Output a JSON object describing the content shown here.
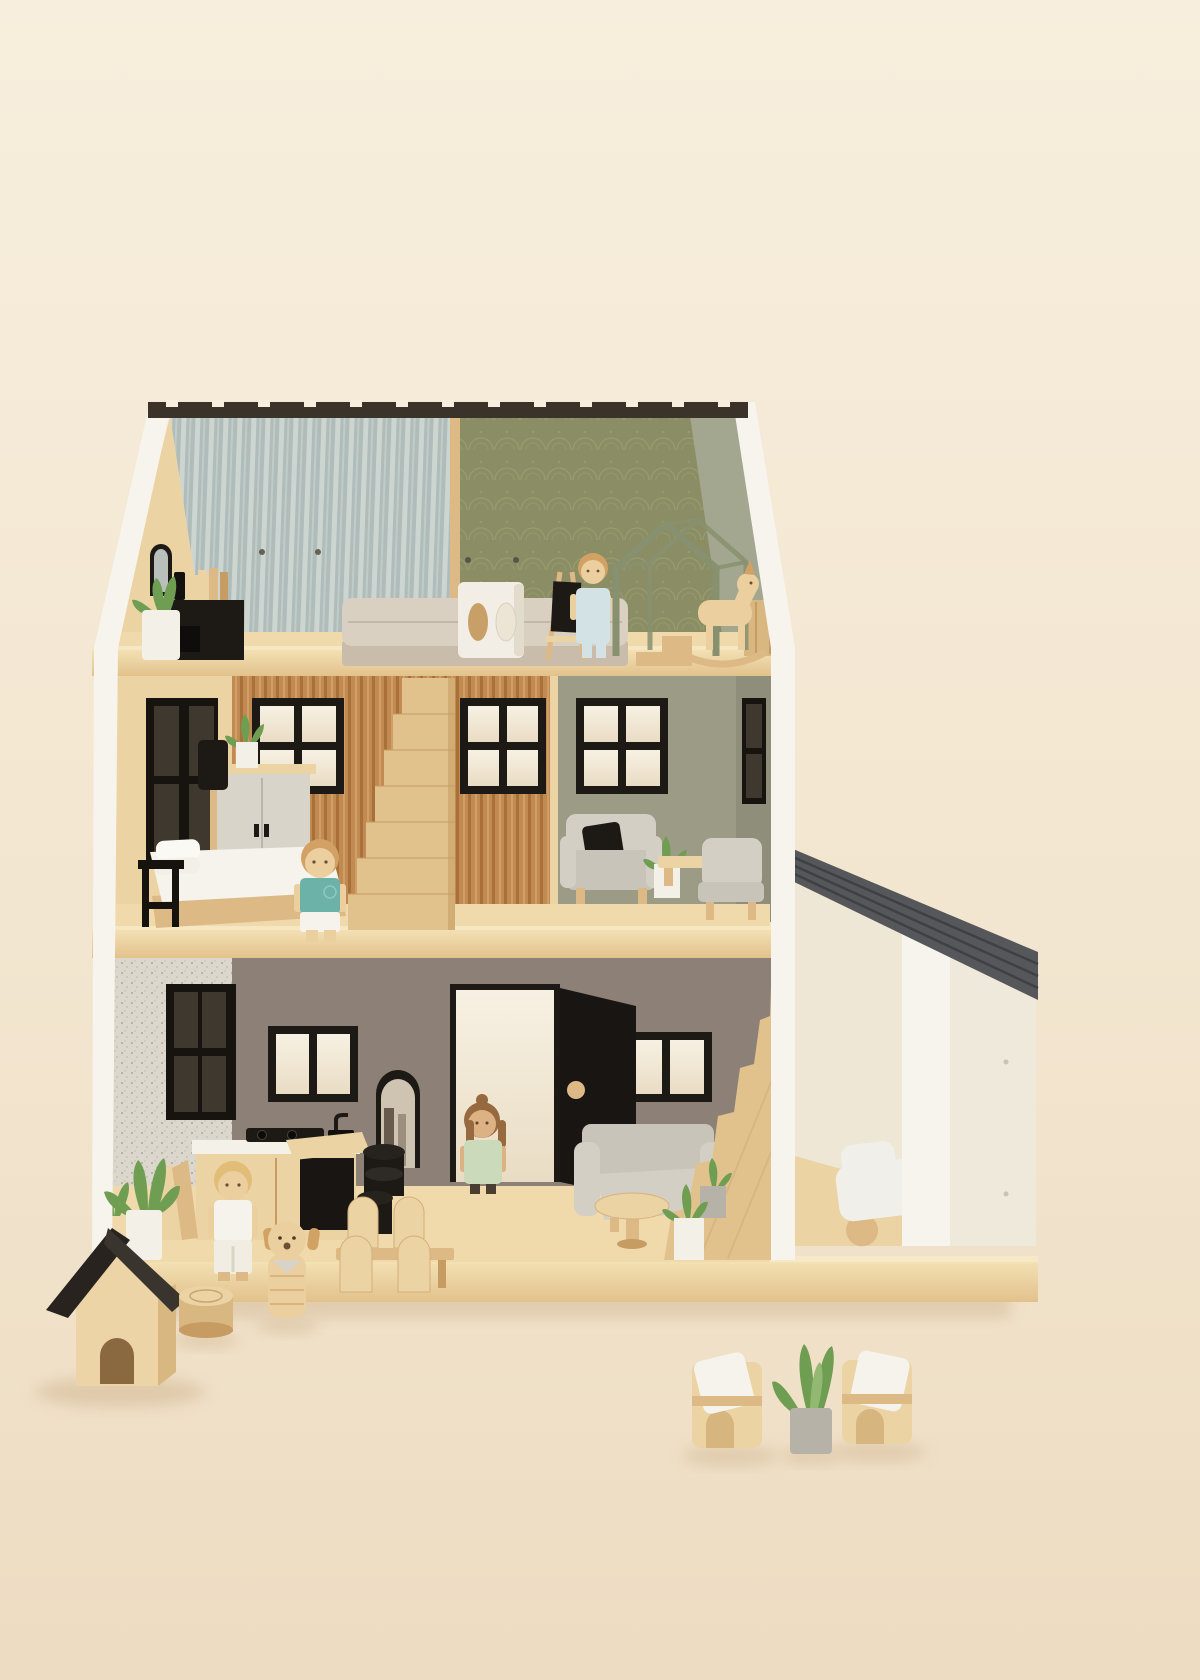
{
  "scene": {
    "description": "Studio photograph of a three-storey open-front wooden toy dollhouse with attached carport, furnished miniature rooms, four peg-doll figures, a toy dog, kennel and garden furniture on a cream backdrop",
    "background": {
      "type": "seamless studio backdrop",
      "top_color": "#f7eddb",
      "bottom_color": "#eddcc2"
    },
    "palette": {
      "bg_top": "#f7eedd",
      "bg_mid": "#f3e6d0",
      "bg_bottom": "#eddcc2",
      "white_wall": "#f7f4ed",
      "white_wall_shade": "#efe9dc",
      "inner_cream": "#efe7d5",
      "ridge_dark": "#3b332a",
      "roof_black": "#28231f",
      "roof_black_side": "#3a342e",
      "garage_roof": "#56575a",
      "garage_roof_line": "#3f4043",
      "wood_floor_hi": "#f3e0b4",
      "wood_floor_lo": "#e2c28c",
      "floor_strip": "#f0d9ab",
      "wood_light": "#ecd3a3",
      "wood_mid": "#ddba85",
      "wood_dark": "#c79c63",
      "wood_deep": "#a97c49",
      "wp_stripe_base": "#b0bcb9",
      "wp_stripe_lite": "#cdd5d0",
      "wp_olive_base": "#8b8d64",
      "wp_olive_line": "#a3a578",
      "wp_tan_base": "#c08a52",
      "wp_tan_dark": "#a8713a",
      "wp_tan_lite": "#d4a468",
      "wall_sage": "#9c9c86",
      "wall_sage_dark": "#8e8e7a",
      "wall_grey": "#8d8177",
      "wp_speckle_base": "#dcd7cd",
      "wp_speckle_dot": "#aea699",
      "black_paint": "#1d1a16",
      "black_soft": "#2e2a25",
      "window_glow_a": "#f7f1e3",
      "window_glow_b": "#e9dcc4",
      "dark_window": "#171410",
      "dark_window_pane": "#3e382e",
      "grey_sofa": "#c9c4ba",
      "grey_sofa_lite": "#d4cfc5",
      "mattress": "#dad0c2",
      "mattress_base": "#c9bcab",
      "skin_wood": "#ebcf9f",
      "skin_tan": "#dcb183",
      "hair_blond": "#e2bd77",
      "hair_wood": "#d2a264",
      "hair_brown": "#96693f",
      "shirt_teal": "#6cb2a8",
      "outfit_blue": "#d3e2e5",
      "overalls_green": "#ccdabc",
      "white_cloth": "#f6f3ec",
      "pot_white": "#f3f0e7",
      "pot_grey": "#b7b2a8",
      "plant_green": "#6f9e53",
      "plant_green_lite": "#93b871",
      "frame_sage": "#87906f",
      "car_white": "#f1efe9",
      "shadow_warm": "#d2b893",
      "kennel_wood": "#ecd4a6",
      "kennel_wood_side": "#d8b781",
      "mirror_glass": "#cfc4b2",
      "mirror_dark": "#55493c"
    },
    "house": {
      "storeys": 3,
      "attic": {
        "left_room": {
          "wallpaper": "blue-grey pinstripe",
          "items": [
            "arched wall mirror",
            "black media shelf with black bottle",
            "stack of wooden books",
            "succulent in white pot",
            "upholstered toy bed",
            "wooden step block"
          ]
        },
        "right_room": {
          "wallpaper": "olive art-deco fan pattern",
          "items": [
            "white play cube with oval holes",
            "easel with black chalkboard",
            "child figure in pale blue outfit",
            "sage house-shaped bed frame",
            "wooden rocking horse",
            "wooden slat crate"
          ]
        }
      },
      "middle_floor": {
        "bedroom": {
          "wallpaper": "terracotta pinstripe",
          "items": [
            "dark side window",
            "black casement window",
            "grey two-door wardrobe",
            "black floor lamp",
            "plant in white pot",
            "bed with white bedding and pillows",
            "black bedside stand",
            "boy figure in teal shirt"
          ]
        },
        "stairs": "straight wooden staircase with stepped stringer",
        "living_room": {
          "wall": "sage green",
          "items": [
            "black casement window",
            "grey armchair with black cushion",
            "plant in white pot",
            "low wooden bench",
            "grey side chair",
            "dark side window"
          ]
        }
      },
      "ground_floor": {
        "kitchen": {
          "wallpaper": "white speckle",
          "items": [
            "dark side window",
            "wooden counter with black cooktop, sink and faucet",
            "leaning chopping boards",
            "mother figure in white outfit",
            "wooden desk with black base",
            "two black stools",
            "dining table with four wooden chairs"
          ]
        },
        "hall": {
          "items": [
            "black two-pane window",
            "arched floor mirror",
            "open white front door with round wooden knob",
            "girl figure in green overalls"
          ]
        },
        "living_room": {
          "items": [
            "grey corner sofa",
            "round wooden coffee table",
            "aloe plants in white and grey pots",
            "scallop-edged wooden staircase",
            "black two-pane window"
          ]
        }
      },
      "garage": {
        "roof": "slanted grey plank roof",
        "walls": "white carport",
        "items": [
          "white toy car with wooden wheels"
        ]
      }
    },
    "figures": [
      {
        "name": "mother",
        "outfit": "white top and trousers",
        "hair": "blond bob",
        "location": "kitchen"
      },
      {
        "name": "girl",
        "outfit": "sage green overalls",
        "hair": "brown with top bun",
        "location": "hall by front door"
      },
      {
        "name": "boy",
        "outfit": "teal t-shirt and white shorts",
        "hair": "light wood",
        "location": "bedroom"
      },
      {
        "name": "child",
        "outfit": "pale blue overalls",
        "hair": "light wood",
        "location": "attic playroom"
      }
    ],
    "outdoor_items": [
      "wooden dog kennel with black gable roof",
      "wooden log slice",
      "wooden dog figure with speckled bandana",
      "aloe plant in white pot by doorway",
      "two wooden garden armchairs with white cushions",
      "aloe plant in grey concrete pot"
    ]
  }
}
